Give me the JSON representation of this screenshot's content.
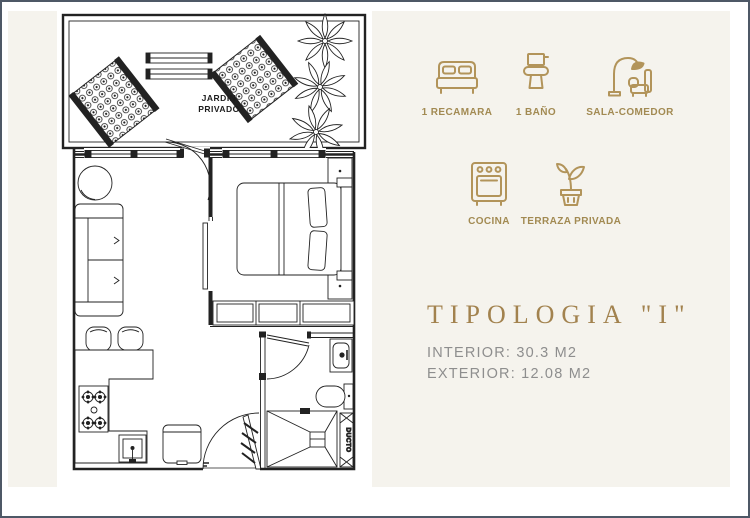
{
  "plan": {
    "garden_label_line1": "JARDIN",
    "garden_label_line2": "PRIVADO",
    "duct_label": "DUCTO"
  },
  "features": [
    {
      "icon": "bed-icon",
      "label": "1 RECAMARA"
    },
    {
      "icon": "toilet-icon",
      "label": "1 BAÑO"
    },
    {
      "icon": "sofa-lamp-icon",
      "label": "SALA-COMEDOR"
    },
    {
      "icon": "stove-icon",
      "label": "COCINA"
    },
    {
      "icon": "potted-plant-icon",
      "label": "TERRAZA PRIVADA"
    }
  ],
  "typology": {
    "title": "TIPOLOGIA \"I\"",
    "interior": "INTERIOR: 30.3 M2",
    "exterior": "EXTERIOR: 12.08 M2"
  },
  "colors": {
    "accent_gold": "#b2945a",
    "label_gold": "#a28a52",
    "title_bronze": "#a2824e",
    "spec_gray": "#8e8e8e",
    "background_cream": "#f5f3ed",
    "plan_line": "#222222",
    "frame_border": "#4e5866"
  }
}
